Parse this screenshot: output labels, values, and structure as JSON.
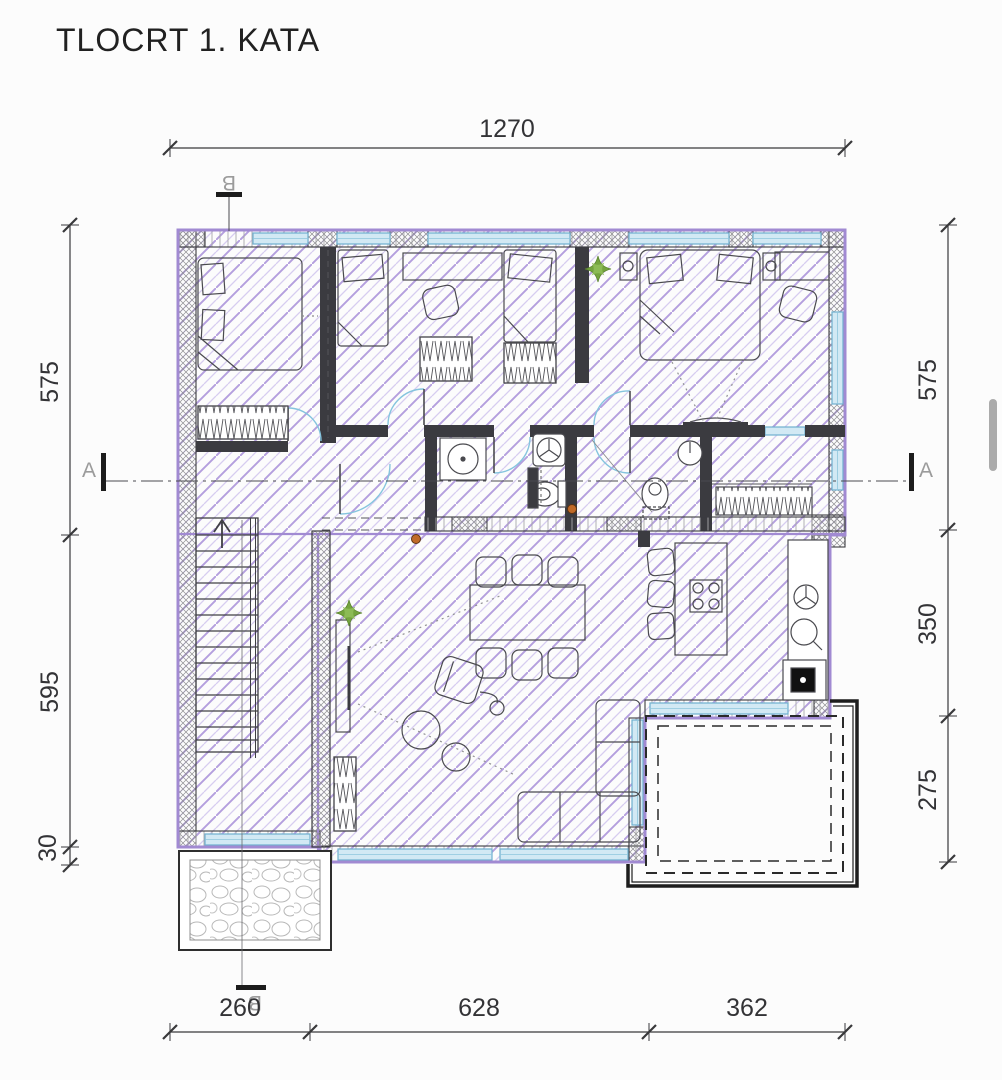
{
  "title": "TLOCRT 1. KATA",
  "dimensions": {
    "top": [
      "1270"
    ],
    "bottom": [
      "260",
      "628",
      "362"
    ],
    "left": [
      "575",
      "595",
      "30"
    ],
    "right": [
      "575",
      "350",
      "275"
    ]
  },
  "sections": {
    "a": "A",
    "b": "B"
  },
  "colors": {
    "envelope_purple": "#a18ad2",
    "hatch_violet": "#b49fde",
    "wall_dark": "#3b3b40",
    "window_blue": "#6fb0cf",
    "door_arc_blue": "#85c4de",
    "plant_green": "#74a43e",
    "accent_orange": "#c06a28",
    "dimension_text": "#333336",
    "scrollbar_gray": "#ababab"
  }
}
